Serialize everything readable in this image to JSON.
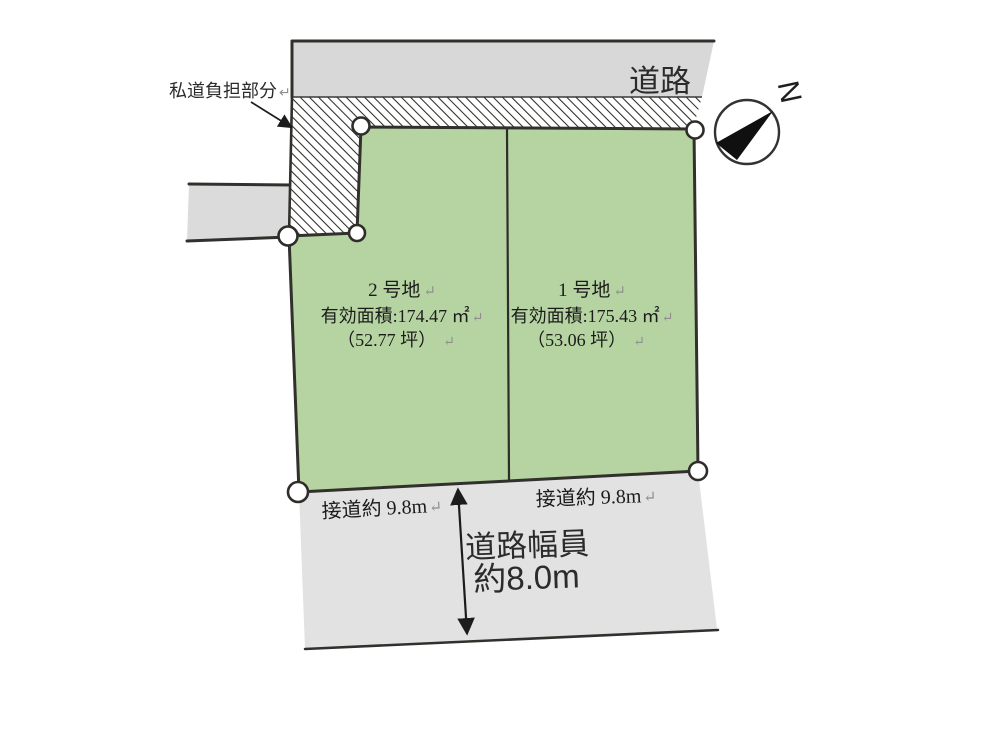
{
  "labels": {
    "road_top": "道路",
    "private_road": "私道負担部分",
    "return_mark": "↵",
    "compass_north": "N",
    "frontage_left": "接道約 9.8m",
    "frontage_right": "接道約 9.8m",
    "road_width_line1": "道路幅員",
    "road_width_line2": "約8.0m"
  },
  "lots": {
    "lot2": {
      "name": "2 号地",
      "area": "有効面積:174.47 ㎡",
      "tsubo": "（52.77 坪）"
    },
    "lot1": {
      "name": "1 号地",
      "area": "有効面積:175.43 ㎡",
      "tsubo": "（53.06 坪）"
    }
  },
  "colors": {
    "lot_green": "#b6d4a2",
    "road_gray_top": "#d8d8d8",
    "road_gray_left": "#dbdbdb",
    "road_gray_bottom": "#e2e2e2",
    "hatch_line": "#2e2c29",
    "outline": "#32302c"
  }
}
